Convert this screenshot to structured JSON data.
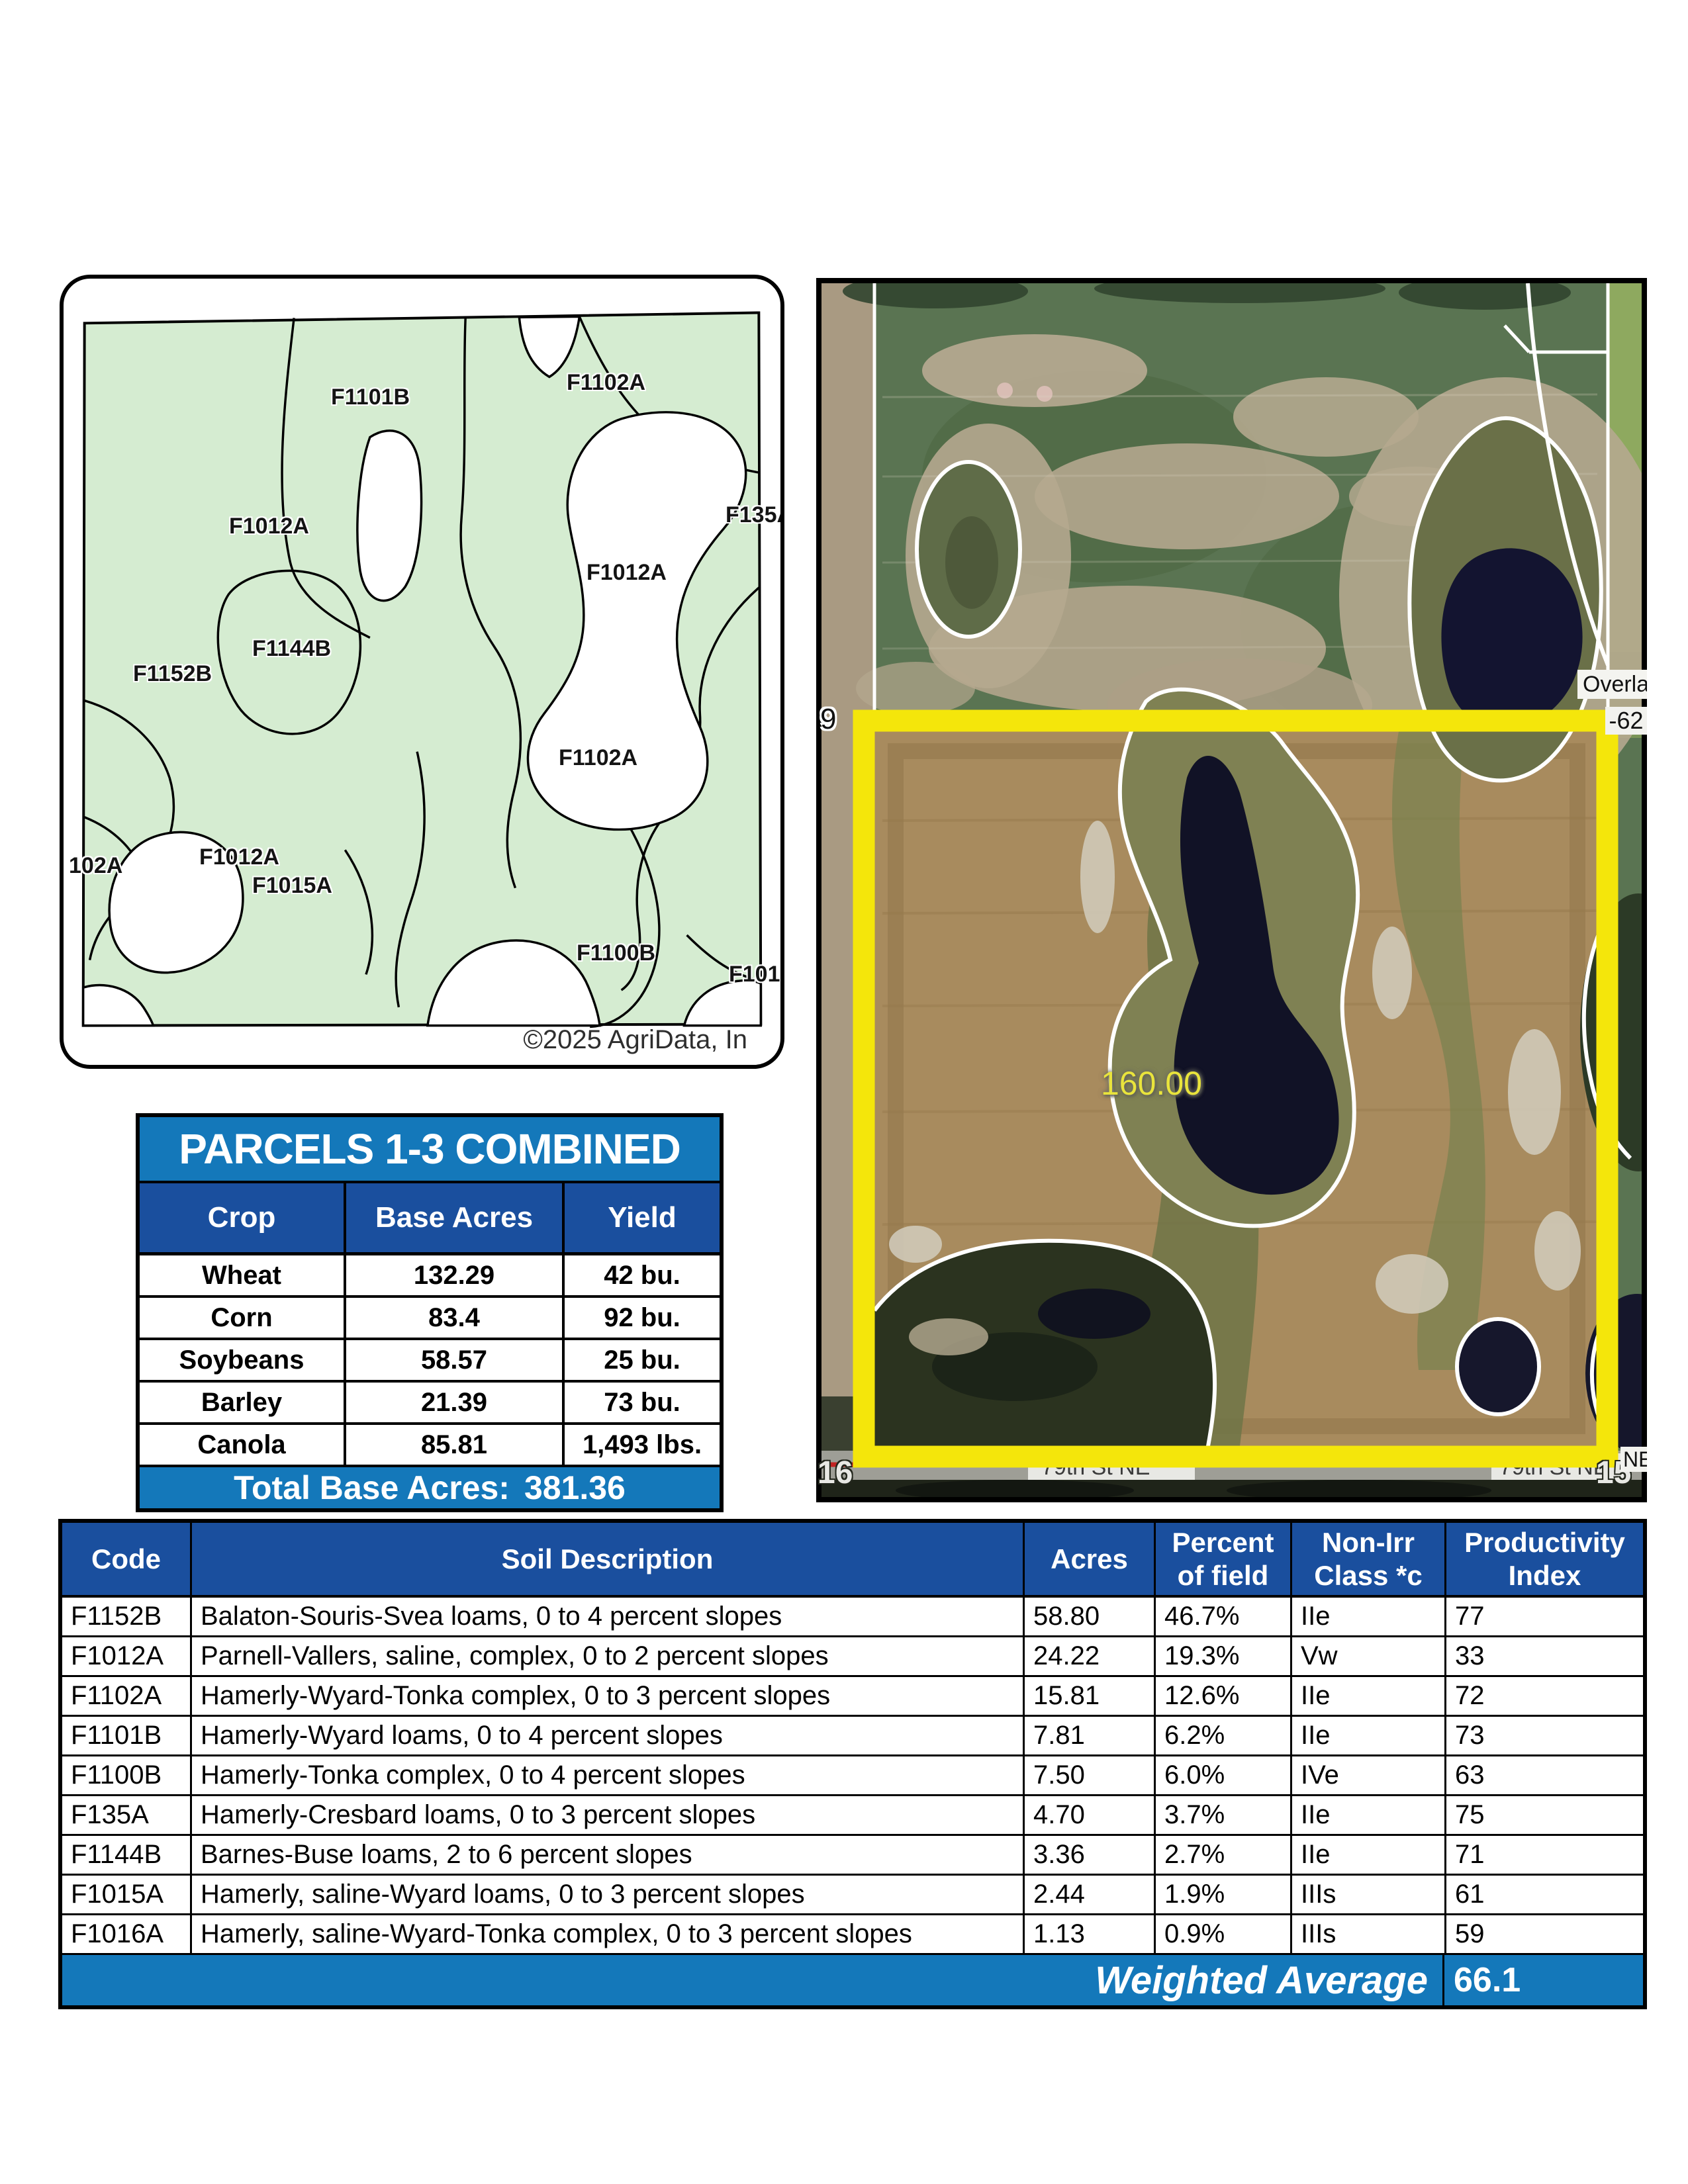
{
  "soil_map": {
    "labels": [
      {
        "text": "F1101B"
      },
      {
        "text": "F1102A"
      },
      {
        "text": "F1012A"
      },
      {
        "text": "F135A"
      },
      {
        "text": "F1012A"
      },
      {
        "text": "F1144B"
      },
      {
        "text": "F1152B"
      },
      {
        "text": "F1102A"
      },
      {
        "text": "102A"
      },
      {
        "text": "F1012A"
      },
      {
        "text": "F1015A"
      },
      {
        "text": "F1100B"
      },
      {
        "text": "F1016A"
      }
    ],
    "copyright": "©2025 AgriData, In",
    "map_green": "#d5ecd1"
  },
  "aerial": {
    "area_value": "160.00",
    "section_left": "9",
    "road_ref": "-62",
    "road_name": "Overland",
    "section_bottom_left": "16",
    "section_bottom_right": "15",
    "road_ne": "NE",
    "road_bottom": "79th St NE",
    "boundary_yellow": "#f4e60b",
    "area_label_color": "#e9e43c"
  },
  "parcels_table": {
    "title": "PARCELS 1-3 COMBINED",
    "columns": [
      "Crop",
      "Base Acres",
      "Yield"
    ],
    "rows": [
      [
        "Wheat",
        "132.29",
        "42 bu."
      ],
      [
        "Corn",
        "83.4",
        "92 bu."
      ],
      [
        "Soybeans",
        "58.57",
        "25 bu."
      ],
      [
        "Barley",
        "21.39",
        "73 bu."
      ],
      [
        "Canola",
        "85.81",
        "1,493 lbs."
      ]
    ],
    "footer_label": "Total Base Acres:",
    "footer_value": "381.36"
  },
  "soil_table": {
    "columns": [
      "Code",
      "Soil Description",
      "Acres",
      "Percent of field",
      "Non-Irr Class *c",
      "Productivity Index"
    ],
    "rows": [
      [
        "F1152B",
        "Balaton-Souris-Svea loams, 0 to 4 percent slopes",
        "58.80",
        "46.7%",
        "IIe",
        "77"
      ],
      [
        "F1012A",
        "Parnell-Vallers, saline, complex, 0 to 2 percent slopes",
        "24.22",
        "19.3%",
        "Vw",
        "33"
      ],
      [
        "F1102A",
        "Hamerly-Wyard-Tonka complex, 0 to 3 percent slopes",
        "15.81",
        "12.6%",
        "IIe",
        "72"
      ],
      [
        "F1101B",
        "Hamerly-Wyard loams, 0 to 4 percent slopes",
        "7.81",
        "6.2%",
        "IIe",
        "73"
      ],
      [
        "F1100B",
        "Hamerly-Tonka complex, 0 to 4 percent slopes",
        "7.50",
        "6.0%",
        "IVe",
        "63"
      ],
      [
        "F135A",
        "Hamerly-Cresbard loams, 0 to 3 percent slopes",
        "4.70",
        "3.7%",
        "IIe",
        "75"
      ],
      [
        "F1144B",
        "Barnes-Buse loams, 2 to 6 percent slopes",
        "3.36",
        "2.7%",
        "IIe",
        "71"
      ],
      [
        "F1015A",
        "Hamerly, saline-Wyard loams, 0 to 3 percent slopes",
        "2.44",
        "1.9%",
        "IIIs",
        "61"
      ],
      [
        "F1016A",
        "Hamerly, saline-Wyard-Tonka complex, 0 to 3 percent slopes",
        "1.13",
        "0.9%",
        "IIIs",
        "59"
      ]
    ],
    "footer_label": "Weighted Average",
    "footer_value": "66.1"
  },
  "colors": {
    "accent_blue": "#1478ba",
    "header_navy": "#1a4f9e",
    "border_black": "#000000"
  }
}
